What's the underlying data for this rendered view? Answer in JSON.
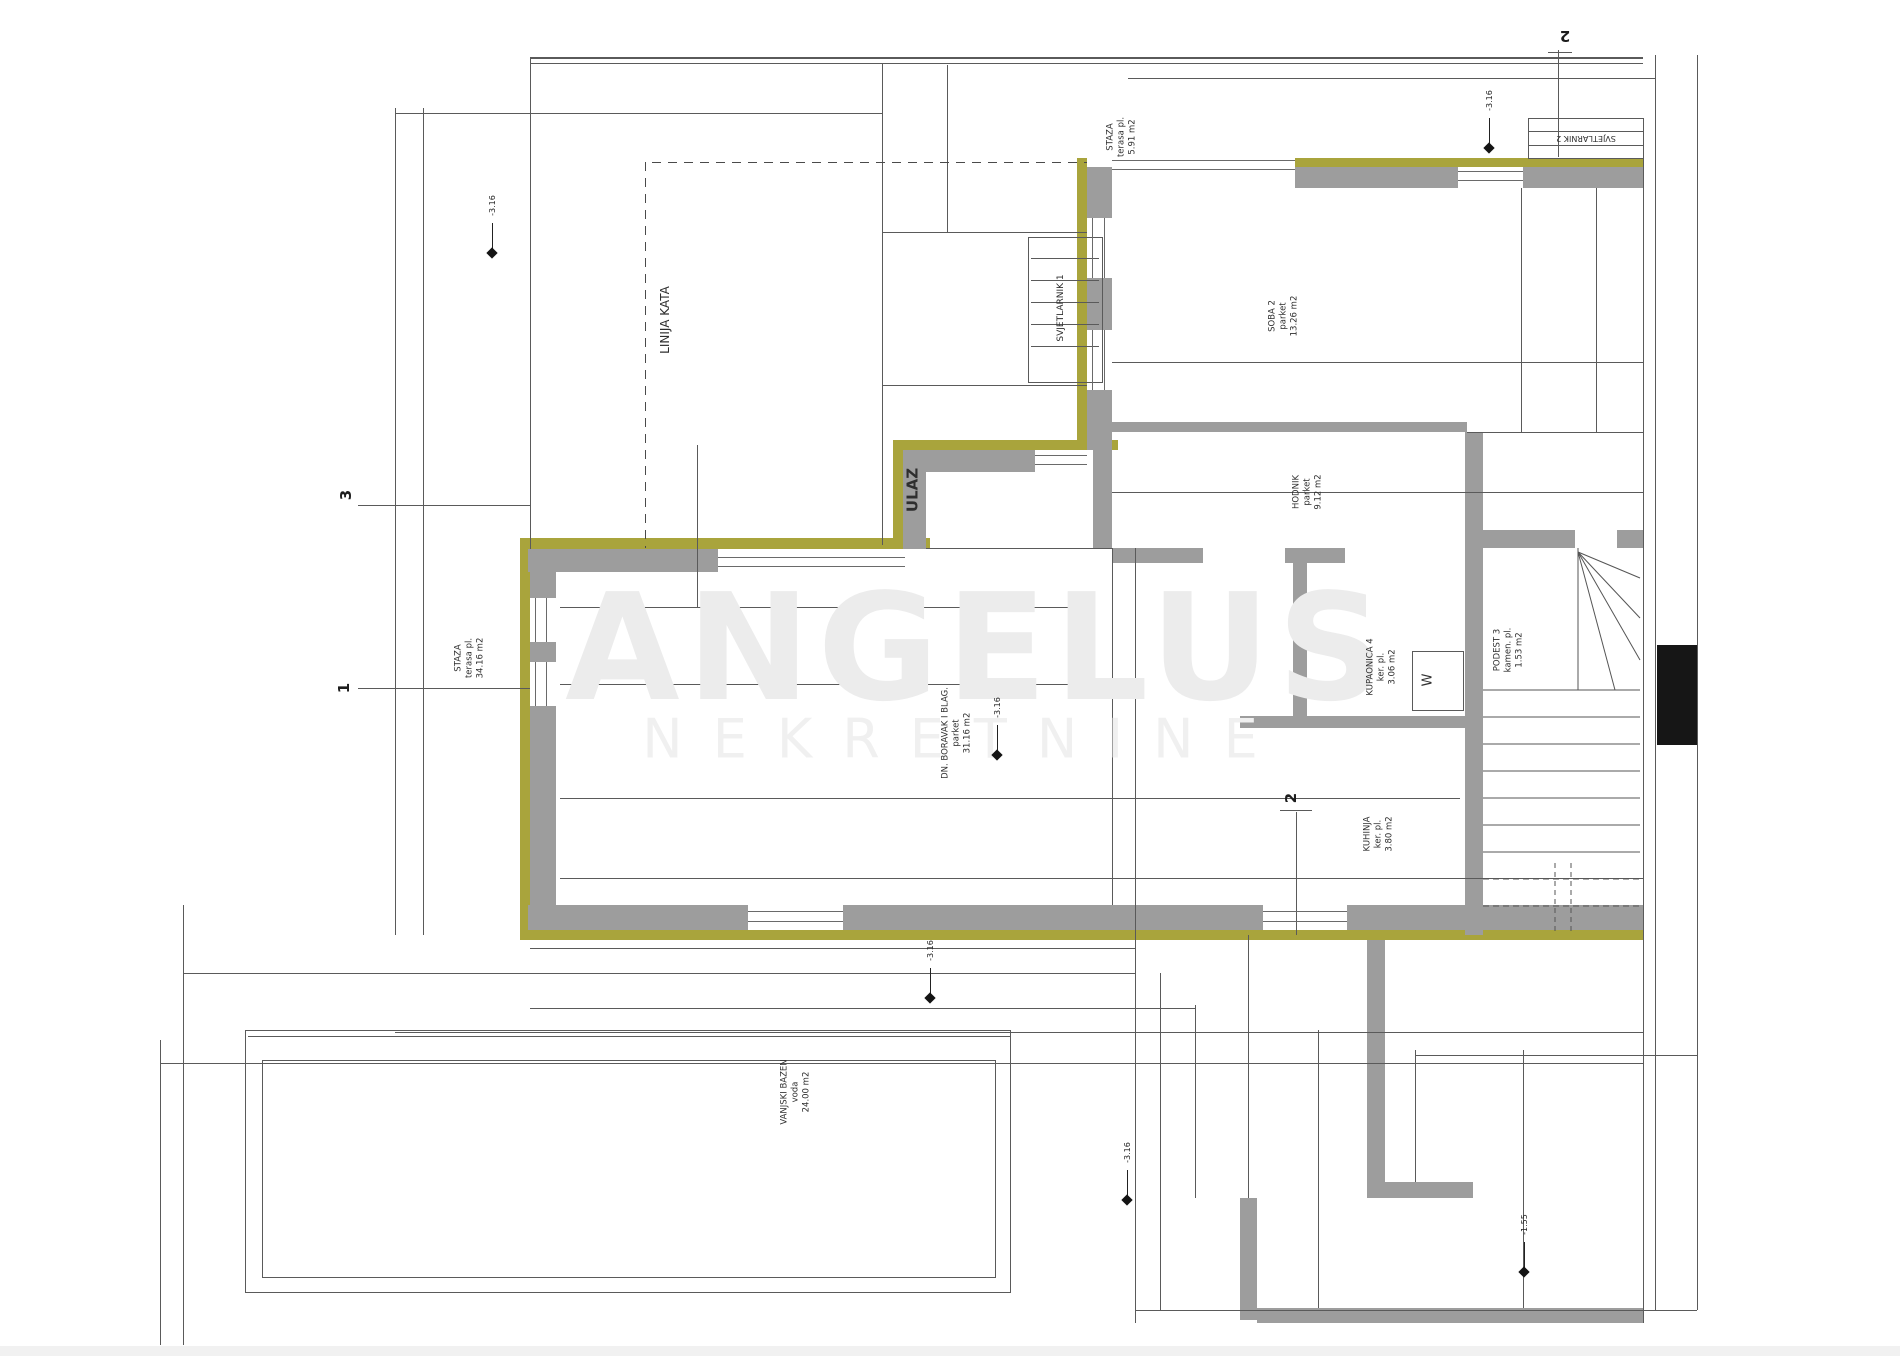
{
  "watermark": {
    "line1": "ANGELUS",
    "line2": "NEKRETNINE"
  },
  "colors": {
    "wall": "#9d9d9d",
    "insulation": "#a9a43c",
    "line": "#5a5a5a",
    "window_line": "#6a6a6a",
    "black_fill": "#161616",
    "text": "#3b3b3b"
  },
  "rooms": [
    {
      "name": "LINIJA KATA",
      "x": 666,
      "y": 320,
      "r": -90,
      "fs": 12
    },
    {
      "name": "STAZA",
      "sub": "terasa pl.",
      "area": "5.91 m2",
      "x": 1122,
      "y": 137,
      "r": -90
    },
    {
      "name": "SVJETLARNIK 1",
      "x": 1062,
      "y": 308,
      "r": -90,
      "fs": 9
    },
    {
      "name": "SOBA 2",
      "sub": "parket",
      "area": "13.26 m2",
      "x": 1284,
      "y": 316,
      "r": -90
    },
    {
      "name": "HODNIK",
      "sub": "parket",
      "area": "9.12 m2",
      "x": 1308,
      "y": 492,
      "r": -90
    },
    {
      "name": "KUPAONICA 4",
      "sub": "ker. pl.",
      "area": "3.06 m2",
      "x": 1382,
      "y": 667,
      "r": -90
    },
    {
      "name": "KUHINJA",
      "sub": "ker. pl.",
      "area": "3.80 m2",
      "x": 1379,
      "y": 834,
      "r": -90
    },
    {
      "name": "PODEST 3",
      "sub": "kamen. pl.",
      "area": "1.53 m2",
      "x": 1509,
      "y": 650,
      "r": -90
    },
    {
      "name": "DN. BORAVAK I BLAG.",
      "sub": "parket",
      "area": "31.16 m2",
      "x": 957,
      "y": 733,
      "r": -90
    },
    {
      "name": "VANJSKI BAZEN",
      "sub": "voda",
      "area": "24.00 m2",
      "x": 796,
      "y": 1092,
      "r": -90
    },
    {
      "name": "ULAZ",
      "x": 913,
      "y": 490,
      "r": -90,
      "fs": 15,
      "bold": true
    },
    {
      "name": "STAZA",
      "sub": "terasa pl.",
      "area": "34.16 m2",
      "x": 470,
      "y": 658,
      "r": -90
    },
    {
      "name": "SVJETLARNIK 2",
      "x": 1586,
      "y": 138,
      "r": 180,
      "fs": 8
    }
  ],
  "dims": [
    {
      "t": "629",
      "x": 748,
      "y": 91,
      "r": 180
    },
    {
      "t": "1.085",
      "x": 1170,
      "y": 31,
      "r": 180
    },
    {
      "t": "595",
      "x": 1032,
      "y": 114,
      "r": -90
    },
    {
      "t": "475",
      "x": 1301,
      "y": 91,
      "r": 180
    },
    {
      "t": "140",
      "x": 1592,
      "y": 94,
      "r": 180
    },
    {
      "t": "253",
      "x": 1180,
      "y": 167,
      "r": 180,
      "fs": 7
    },
    {
      "t": "241",
      "x": 1215,
      "y": 167,
      "r": 180,
      "fs": 7
    },
    {
      "t": "202",
      "x": 1253,
      "y": 167,
      "r": 180,
      "fs": 7
    },
    {
      "t": "46",
      "x": 1289,
      "y": 183,
      "r": 180,
      "fs": 7
    },
    {
      "t": "20",
      "x": 1152,
      "y": 177,
      "r": -90,
      "fs": 7
    },
    {
      "t": "20",
      "x": 1228,
      "y": 177,
      "r": -90,
      "fs": 7
    },
    {
      "t": "178",
      "x": 1590,
      "y": 219,
      "r": -90
    },
    {
      "t": "360",
      "x": 1634,
      "y": 298,
      "r": -90
    },
    {
      "t": "610",
      "x": 1353,
      "y": 267,
      "r": -90
    },
    {
      "t": "280",
      "x": 1380,
      "y": 304,
      "r": -90
    },
    {
      "t": "278",
      "x": 1149,
      "y": 314,
      "r": -90
    },
    {
      "t": "215",
      "x": 1218,
      "y": 311,
      "r": -90,
      "fs": 7
    },
    {
      "t": "430",
      "x": 1224,
      "y": 366,
      "r": -90
    },
    {
      "t": "329",
      "x": 1258,
      "y": 389,
      "r": 180
    },
    {
      "t": "59",
      "x": 1634,
      "y": 317,
      "r": -90,
      "fs": 7
    },
    {
      "t": "725",
      "x": 1433,
      "y": 497,
      "r": 180
    },
    {
      "t": "215",
      "x": 1247,
      "y": 597,
      "r": 180,
      "fs": 7
    },
    {
      "t": "84",
      "x": 1247,
      "y": 611,
      "r": 180,
      "fs": 7
    },
    {
      "t": "95",
      "x": 1315,
      "y": 610,
      "r": 180,
      "fs": 7
    },
    {
      "t": "215",
      "x": 1392,
      "y": 597,
      "r": 180,
      "fs": 7
    },
    {
      "t": "81",
      "x": 1393,
      "y": 611,
      "r": 180,
      "fs": 7
    },
    {
      "t": "247",
      "x": 1082,
      "y": 607,
      "r": 180
    },
    {
      "t": "241",
      "x": 800,
      "y": 603,
      "r": 180
    },
    {
      "t": "222",
      "x": 637,
      "y": 610,
      "r": 180
    },
    {
      "t": "170",
      "x": 1355,
      "y": 648,
      "r": -90
    },
    {
      "t": "190",
      "x": 1384,
      "y": 748,
      "r": 180
    },
    {
      "t": "110",
      "x": 1350,
      "y": 732,
      "r": -90,
      "fs": 7
    },
    {
      "t": "2.00",
      "x": 1355,
      "y": 824,
      "r": -90
    },
    {
      "t": "170",
      "x": 1031,
      "y": 470,
      "r": -90
    },
    {
      "t": "825",
      "x": 911,
      "y": 684,
      "r": 180
    },
    {
      "t": "1.010",
      "x": 1005,
      "y": 799,
      "r": 180
    },
    {
      "t": "840",
      "x": 399,
      "y": 345,
      "r": -90
    },
    {
      "t": "430",
      "x": 431,
      "y": 288,
      "r": -90
    },
    {
      "t": "420",
      "x": 431,
      "y": 740,
      "r": -90
    },
    {
      "t": "100",
      "x": 683,
      "y": 502,
      "r": 180,
      "fs": 7
    },
    {
      "t": "90",
      "x": 539,
      "y": 612,
      "r": -90,
      "fs": 7
    },
    {
      "t": "90",
      "x": 539,
      "y": 686,
      "r": -90,
      "fs": 7
    },
    {
      "t": "30",
      "x": 592,
      "y": 561,
      "r": -90,
      "fs": 7
    },
    {
      "t": "30",
      "x": 852,
      "y": 561,
      "r": -90,
      "fs": 7
    },
    {
      "t": "30",
      "x": 1100,
      "y": 468,
      "r": -90,
      "fs": 7
    },
    {
      "t": "60",
      "x": 598,
      "y": 886,
      "r": -90,
      "fs": 7
    },
    {
      "t": "220",
      "x": 642,
      "y": 884,
      "r": 180
    },
    {
      "t": "103",
      "x": 757,
      "y": 884,
      "r": 180,
      "fs": 7
    },
    {
      "t": "241",
      "x": 795,
      "y": 876,
      "r": 180,
      "fs": 7
    },
    {
      "t": "102",
      "x": 795,
      "y": 888,
      "r": 180,
      "fs": 7
    },
    {
      "t": "158",
      "x": 868,
      "y": 894,
      "r": 180
    },
    {
      "t": "241",
      "x": 985,
      "y": 876,
      "r": 180,
      "fs": 7
    },
    {
      "t": "103",
      "x": 985,
      "y": 888,
      "r": 180,
      "fs": 7
    },
    {
      "t": "208",
      "x": 1060,
      "y": 883,
      "r": 180
    },
    {
      "t": "130",
      "x": 1406,
      "y": 885,
      "r": 180
    },
    {
      "t": "121",
      "x": 1542,
      "y": 886,
      "r": 180
    },
    {
      "t": "30",
      "x": 1226,
      "y": 921,
      "r": -90,
      "fs": 7
    },
    {
      "t": "30",
      "x": 1356,
      "y": 921,
      "r": -90,
      "fs": 7
    },
    {
      "t": "70",
      "x": 1037,
      "y": 792,
      "r": -90,
      "fs": 7
    },
    {
      "t": "50",
      "x": 684,
      "y": 954,
      "r": -90,
      "fs": 7
    },
    {
      "t": "30",
      "x": 684,
      "y": 984,
      "r": -90,
      "fs": 7
    },
    {
      "t": "800",
      "x": 621,
      "y": 1067,
      "r": 180
    },
    {
      "t": "300",
      "x": 686,
      "y": 1085,
      "r": -90
    },
    {
      "t": "90",
      "x": 172,
      "y": 921,
      "r": -90,
      "fs": 7
    },
    {
      "t": "40",
      "x": 521,
      "y": 1298,
      "r": -90,
      "fs": 7
    },
    {
      "t": "1.380",
      "x": 1157,
      "y": 1032,
      "r": 180
    },
    {
      "t": "205",
      "x": 1180,
      "y": 1011,
      "r": 180
    },
    {
      "t": "290",
      "x": 1058,
      "y": 1066,
      "r": 180,
      "fs": 7
    },
    {
      "t": "230",
      "x": 1120,
      "y": 1066,
      "r": 180,
      "fs": 7
    },
    {
      "t": "120",
      "x": 1312,
      "y": 1066,
      "r": 180,
      "fs": 7
    },
    {
      "t": "184",
      "x": 1343,
      "y": 1043,
      "r": -90,
      "fs": 7
    },
    {
      "t": "280",
      "x": 1429,
      "y": 1051,
      "r": -90
    },
    {
      "t": "116",
      "x": 1345,
      "y": 1146,
      "r": -90,
      "fs": 7
    },
    {
      "t": "120",
      "x": 1347,
      "y": 1252,
      "r": -90,
      "fs": 7
    },
    {
      "t": "120",
      "x": 1430,
      "y": 1252,
      "r": -90,
      "fs": 7
    },
    {
      "t": "235",
      "x": 1360,
      "y": 1278,
      "r": 180
    },
    {
      "t": "490",
      "x": 1650,
      "y": 847,
      "r": -90
    },
    {
      "t": "215",
      "x": 1526,
      "y": 603,
      "r": 180,
      "fs": 7
    },
    {
      "t": "131",
      "x": 1541,
      "y": 630,
      "r": 180,
      "fs": 7
    },
    {
      "t": "9.R @ 17",
      "x": 1527,
      "y": 836,
      "r": -90,
      "fs": 7
    },
    {
      "t": "8.T @ 29",
      "x": 1539,
      "y": 836,
      "r": -90,
      "fs": 7
    }
  ],
  "markers": [
    {
      "t": "-3.16",
      "x": 492,
      "y": 253
    },
    {
      "t": "-3.16",
      "x": 997,
      "y": 755
    },
    {
      "t": "-3.16",
      "x": 930,
      "y": 998
    },
    {
      "t": "-3.16",
      "x": 1127,
      "y": 1200
    },
    {
      "t": "-1.55",
      "x": 1524,
      "y": 1272
    },
    {
      "t": "-3.16",
      "x": 1489,
      "y": 148
    }
  ],
  "sections": [
    {
      "t": "2",
      "x": 1565,
      "y": 36,
      "r": 180
    },
    {
      "t": "3",
      "x": 346,
      "y": 495,
      "r": -90
    },
    {
      "t": "1",
      "x": 344,
      "y": 688,
      "r": -90
    },
    {
      "t": "2",
      "x": 1291,
      "y": 798,
      "r": -90
    }
  ],
  "stairs": {
    "washer_label": "W"
  }
}
